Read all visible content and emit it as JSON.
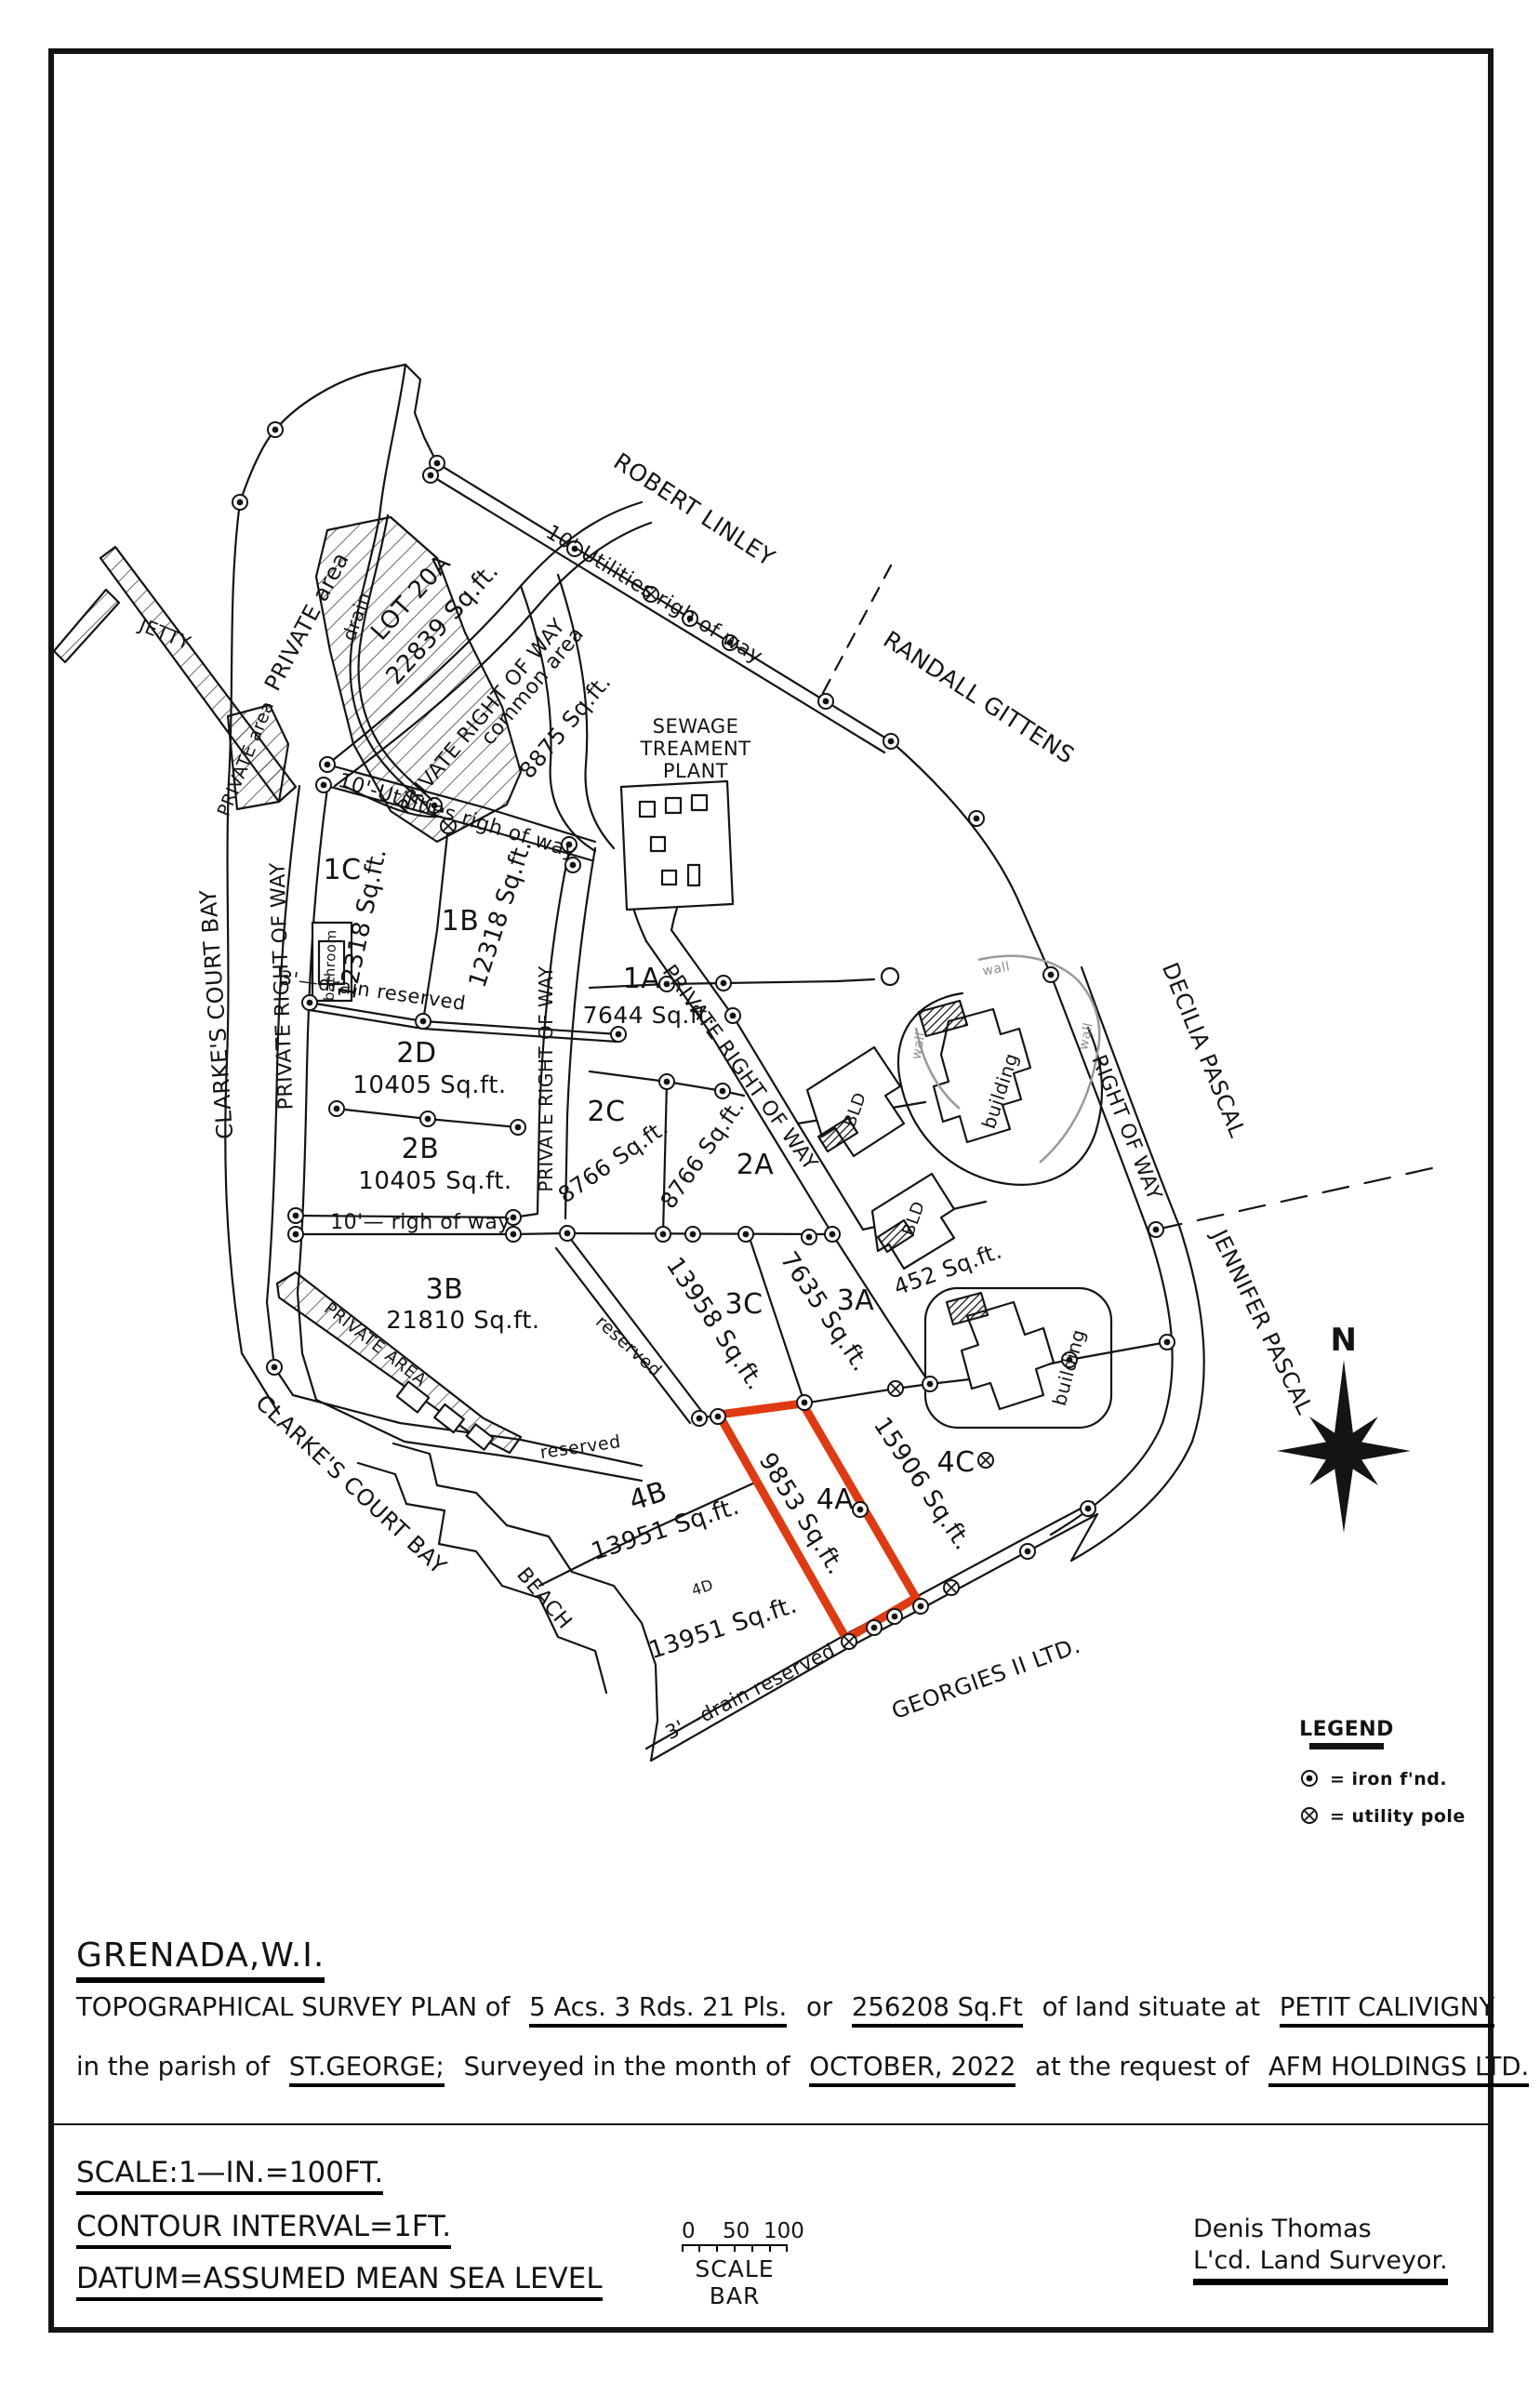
{
  "page": {
    "bg": "#ffffff",
    "ink": "#141414",
    "accent_red": "#e03a12",
    "wall_gray": "#9a9a9a"
  },
  "map": {
    "labels": {
      "jetty": "JETTY",
      "drain": "drain",
      "private_area": "PRIVATE area",
      "private_area_caps": "PRIVATE AREA",
      "utilities_row": "10'-Utilities righ of way",
      "prow": "PRIVATE RIGHT OF WAY",
      "right_of_way": "RIGHT OF WAY",
      "common_area": "common area",
      "common_area_sqft": "8875 Sq.ft.",
      "sewage1": "SEWAGE",
      "sewage2": "TREAMENT",
      "sewage3": "PLANT",
      "bathroom": "bathroom",
      "drain_reserved_3ft": "3'—drain reserved",
      "row_10ft": "10'— righ of way",
      "reserved": "reserved",
      "bld": "BLD",
      "building": "building",
      "wall": "wall"
    },
    "parcels": {
      "lot20a": {
        "id": "LOT 20A",
        "area": "22839 Sq.ft."
      },
      "l1a": {
        "id": "1A",
        "area": "7644 Sq.ft."
      },
      "l1b": {
        "id": "1B",
        "area": "12318 Sq.ft."
      },
      "l1c": {
        "id": "1C",
        "area": "12318 Sq.ft."
      },
      "l2a": {
        "id": "2A",
        "area": "8766 Sq.ft."
      },
      "l2b": {
        "id": "2B",
        "area": "10405 Sq.ft."
      },
      "l2c": {
        "id": "2C",
        "area": "8766 Sq.ft."
      },
      "l2d": {
        "id": "2D",
        "area": "10405 Sq.ft."
      },
      "l3a": {
        "id": "3A",
        "area": "7635 Sq.ft."
      },
      "l3b": {
        "id": "3B",
        "area": "21810 Sq.ft."
      },
      "l3c": {
        "id": "3C",
        "area": "13958 Sq.ft."
      },
      "l452": {
        "area": "452 Sq.ft."
      },
      "l4a": {
        "id": "4A",
        "area": "9853 Sq.ft."
      },
      "l4b": {
        "id": "4B",
        "area": "13951 Sq.ft."
      },
      "l4c": {
        "id": "4C",
        "area": "15906 Sq.ft."
      },
      "l4d": {
        "id": "4D",
        "area": "13951 Sq.ft."
      }
    },
    "names": {
      "robert_linley": "ROBERT LINLEY",
      "randall_gittens": "RANDALL GITTENS",
      "decilia_pascal": "DECILIA PASCAL",
      "jennifer_pascal": "JENNIFER PASCAL",
      "georges": "GEORGIES II LTD.",
      "clarkes_court_bay": "CLARKE'S COURT BAY",
      "beach": "BEACH"
    },
    "compass": {
      "north": "N"
    }
  },
  "legend": {
    "title": "LEGEND",
    "iron_label": "= iron f'nd.",
    "utility_label": "= utility pole"
  },
  "titleblock": {
    "region": "GRENADA,W.I.",
    "line1_prefix": "TOPOGRAPHICAL SURVEY PLAN of",
    "line1_area": "5 Acs. 3 Rds. 21 Pls.",
    "line1_or": "or",
    "line1_sqft": "256208 Sq.Ft",
    "line1_mid": "of land situate at",
    "line1_place": "PETIT CALIVIGNY",
    "line2_prefix": "in the parish of",
    "line2_parish": "ST.GEORGE;",
    "line2_mid": "Surveyed in the month of",
    "line2_month": "OCTOBER, 2022",
    "line2_at": "at the request of",
    "line2_client": "AFM HOLDINGS LTD.",
    "scale": "SCALE:1—IN.=100FT.",
    "contour": "CONTOUR INTERVAL=1FT.",
    "datum": "DATUM=ASSUMED MEAN SEA LEVEL",
    "scalebar_0": "0",
    "scalebar_50": "50",
    "scalebar_100": "100",
    "scalebar_label": "SCALE BAR",
    "surveyor_name": "Denis Thomas",
    "surveyor_title": "L'cd. Land Surveyor."
  }
}
